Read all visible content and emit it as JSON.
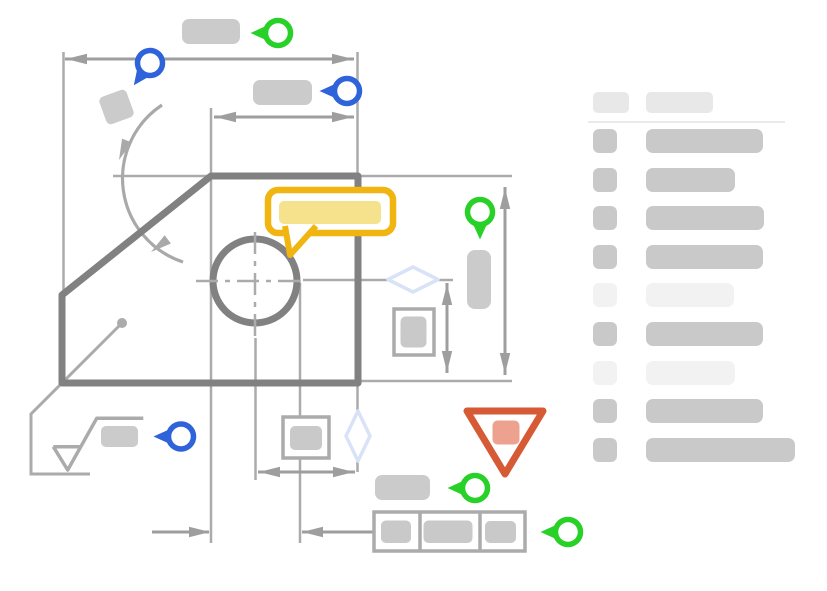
{
  "canvas": {
    "width": 827,
    "height": 591,
    "background": "#FFFFFF"
  },
  "colors": {
    "outline_gray": "#818181",
    "dim_gray": "#9E9E9E",
    "ext_gray": "#ABABAB",
    "arc_gray": "#A9A9A9",
    "placeholder_gray": "#CBCBCB",
    "placeholder_dark": "#C9C9C9",
    "legend_light": "#F2F2F2",
    "legend_header_gray": "#E8E8E8",
    "divider_gray": "#EAEAEA",
    "accent_blue": "#2E63D9",
    "accent_green": "#27D127",
    "accent_yellow": "#F0B511",
    "accent_yellow_light": "#F6E28C",
    "accent_red": "#D65A35",
    "accent_red_light": "#ECA28F",
    "diamond_blue": "#D9E2F7",
    "white": "#FFFFFF"
  },
  "drawing": {
    "shape": "chamfered-plate-outline",
    "features": [
      "horizontal-dimension-top",
      "horizontal-dimension-upper",
      "angular-dimension-arc",
      "bore-circle-with-centerlines",
      "vertical-dimension-right-outer",
      "vertical-dimension-right-inner",
      "diameter-dimension-bottom",
      "width-dimension-bottom",
      "surface-finish-symbol",
      "leader-with-dot",
      "feature-control-frame",
      "datum-diamond-horizontal",
      "datum-diamond-vertical",
      "tolerance-box-right",
      "tolerance-box-bottom"
    ]
  },
  "annotations": {
    "callout": {
      "type": "speech-bubble-callout",
      "fill": "highlighted-text-placeholder"
    },
    "warning": {
      "type": "warning-triangle",
      "fill": "error-text-placeholder"
    },
    "pins": [
      {
        "id": "marker-pin-blue-angled-top-left",
        "color": "blue",
        "x": 150,
        "y": 63,
        "rotation": 36
      },
      {
        "id": "marker-pin-green-top",
        "color": "green",
        "x": 278,
        "y": 33,
        "rotation": 90
      },
      {
        "id": "marker-pin-blue-upper",
        "color": "blue",
        "x": 347,
        "y": 91,
        "rotation": 90
      },
      {
        "id": "marker-pin-green-down-mid",
        "color": "green",
        "x": 480,
        "y": 212,
        "rotation": 0
      },
      {
        "id": "marker-pin-blue-lower-left",
        "color": "blue",
        "x": 181,
        "y": 436.5,
        "rotation": 90
      },
      {
        "id": "marker-pin-green-lower-mid",
        "color": "green",
        "x": 475,
        "y": 488,
        "rotation": 90
      },
      {
        "id": "marker-pin-green-bottom-right",
        "color": "green",
        "x": 568,
        "y": 532,
        "rotation": 90
      }
    ]
  },
  "legend": {
    "header": {
      "swatch": "header-swatch-placeholder",
      "label": "header-label-placeholder"
    },
    "row_start_top": 41,
    "row_spacing": 38.6,
    "rows": [
      {
        "tone": "dark",
        "label_width": 117
      },
      {
        "tone": "dark",
        "label_width": 89
      },
      {
        "tone": "dark",
        "label_width": 118
      },
      {
        "tone": "dark",
        "label_width": 117
      },
      {
        "tone": "light",
        "label_width": 88
      },
      {
        "tone": "dark",
        "label_width": 117
      },
      {
        "tone": "light",
        "label_width": 89
      },
      {
        "tone": "dark",
        "label_width": 117
      },
      {
        "tone": "dark",
        "label_width": 149
      }
    ]
  }
}
